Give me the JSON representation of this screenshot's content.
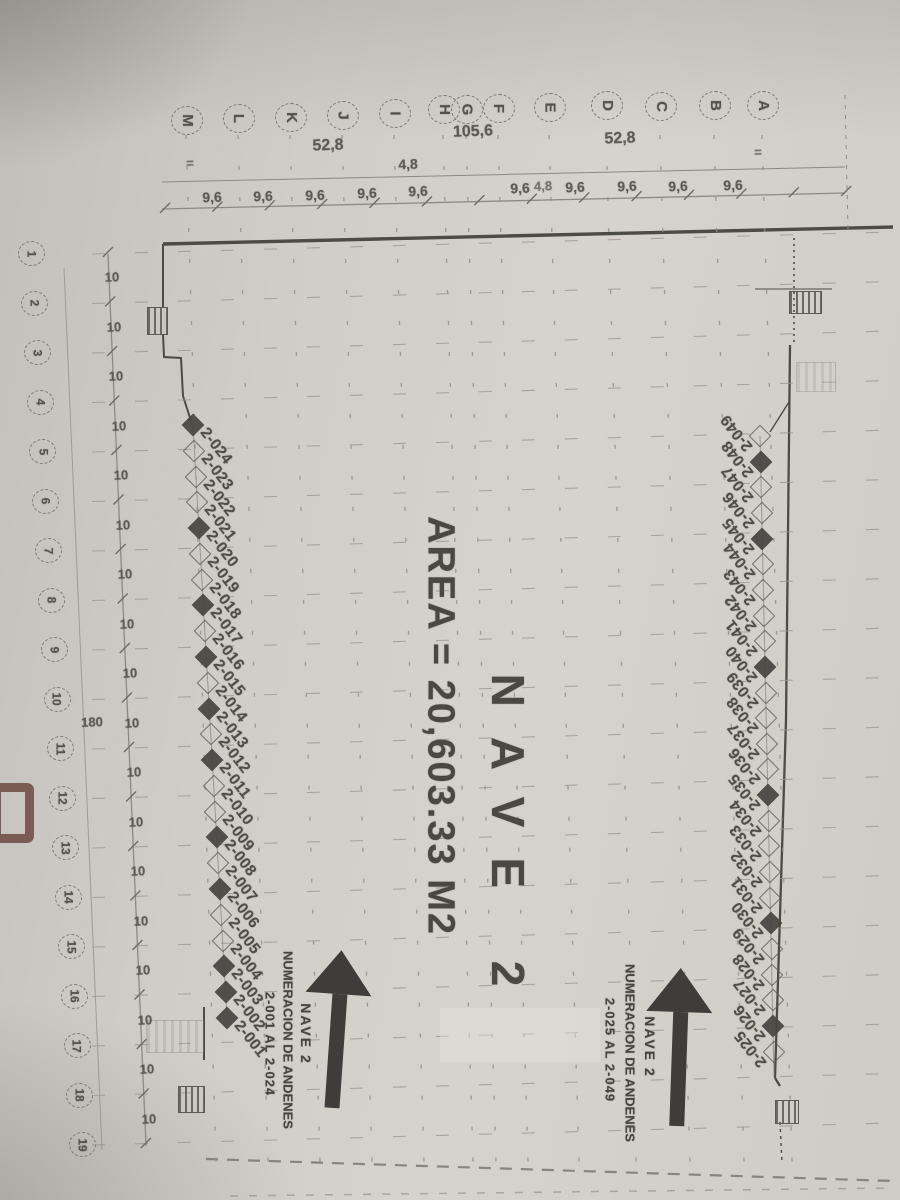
{
  "title": {
    "line1": "NAVE 2",
    "line2": "AREA = 20,603.33 M2"
  },
  "grid": {
    "column_letters": [
      "M",
      "L",
      "K",
      "J",
      "I",
      "H",
      "G",
      "F",
      "E",
      "D",
      "C",
      "B",
      "A"
    ],
    "row_numbers": [
      "1",
      "2",
      "3",
      "4",
      "5",
      "6",
      "7",
      "8",
      "9",
      "10",
      "11",
      "12",
      "13",
      "14",
      "15",
      "16",
      "17",
      "18",
      "19"
    ]
  },
  "dimensions": {
    "top_overall": "105,6",
    "top_left_span": "52,8",
    "top_right_span": "52,8",
    "top_small": "4,8",
    "top_bay": "9,6",
    "left_bay": "10",
    "left_total": "180",
    "tick_mark": "="
  },
  "docks_left": [
    {
      "label": "2-024",
      "filled": true
    },
    {
      "label": "2-023",
      "filled": false
    },
    {
      "label": "2-022",
      "filled": false
    },
    {
      "label": "2-021",
      "filled": false
    },
    {
      "label": "2-020",
      "filled": true
    },
    {
      "label": "2-019",
      "filled": false
    },
    {
      "label": "2-018",
      "filled": false
    },
    {
      "label": "2-017",
      "filled": true
    },
    {
      "label": "2-016",
      "filled": false
    },
    {
      "label": "2-015",
      "filled": true
    },
    {
      "label": "2-014",
      "filled": false
    },
    {
      "label": "2-013",
      "filled": true
    },
    {
      "label": "2-012",
      "filled": false
    },
    {
      "label": "2-011",
      "filled": true
    },
    {
      "label": "2-010",
      "filled": false
    },
    {
      "label": "2-009",
      "filled": false
    },
    {
      "label": "2-008",
      "filled": true
    },
    {
      "label": "2-007",
      "filled": false
    },
    {
      "label": "2-006",
      "filled": true
    },
    {
      "label": "2-005",
      "filled": false
    },
    {
      "label": "2-004",
      "filled": false
    },
    {
      "label": "2-003",
      "filled": true
    },
    {
      "label": "2-002",
      "filled": true
    },
    {
      "label": "2-001",
      "filled": true
    }
  ],
  "docks_right": [
    {
      "label": "2-049",
      "filled": false
    },
    {
      "label": "2-048",
      "filled": true
    },
    {
      "label": "2-047",
      "filled": false
    },
    {
      "label": "2-046",
      "filled": false
    },
    {
      "label": "2-045",
      "filled": true
    },
    {
      "label": "2-044",
      "filled": false
    },
    {
      "label": "2-043",
      "filled": false
    },
    {
      "label": "2-042",
      "filled": false
    },
    {
      "label": "2-041",
      "filled": false
    },
    {
      "label": "2-040",
      "filled": true
    },
    {
      "label": "2-039",
      "filled": false
    },
    {
      "label": "2-038",
      "filled": false
    },
    {
      "label": "2-037",
      "filled": false
    },
    {
      "label": "2-036",
      "filled": false
    },
    {
      "label": "2-035",
      "filled": true
    },
    {
      "label": "2-034",
      "filled": false
    },
    {
      "label": "2-033",
      "filled": false
    },
    {
      "label": "2-032",
      "filled": false
    },
    {
      "label": "2-031",
      "filled": false
    },
    {
      "label": "2-030",
      "filled": true
    },
    {
      "label": "2-029",
      "filled": false
    },
    {
      "label": "2-028",
      "filled": false
    },
    {
      "label": "2-027",
      "filled": false
    },
    {
      "label": "2-026",
      "filled": true
    },
    {
      "label": "2-025",
      "filled": false
    }
  ],
  "annotations": {
    "left_arrow": {
      "line1": "NAVE 2",
      "line2": "NUMERACION DE ANDENES",
      "line3": "2-001 AL 2-024"
    },
    "right_arrow": {
      "line1": "NAVE 2",
      "line2": "NUMERACION DE ANDENES",
      "line3": "2-025 AL 2-049"
    }
  },
  "colors": {
    "ink": "#45433e",
    "paper": "#cfccc6",
    "edge_stamp": "#6d463f"
  }
}
